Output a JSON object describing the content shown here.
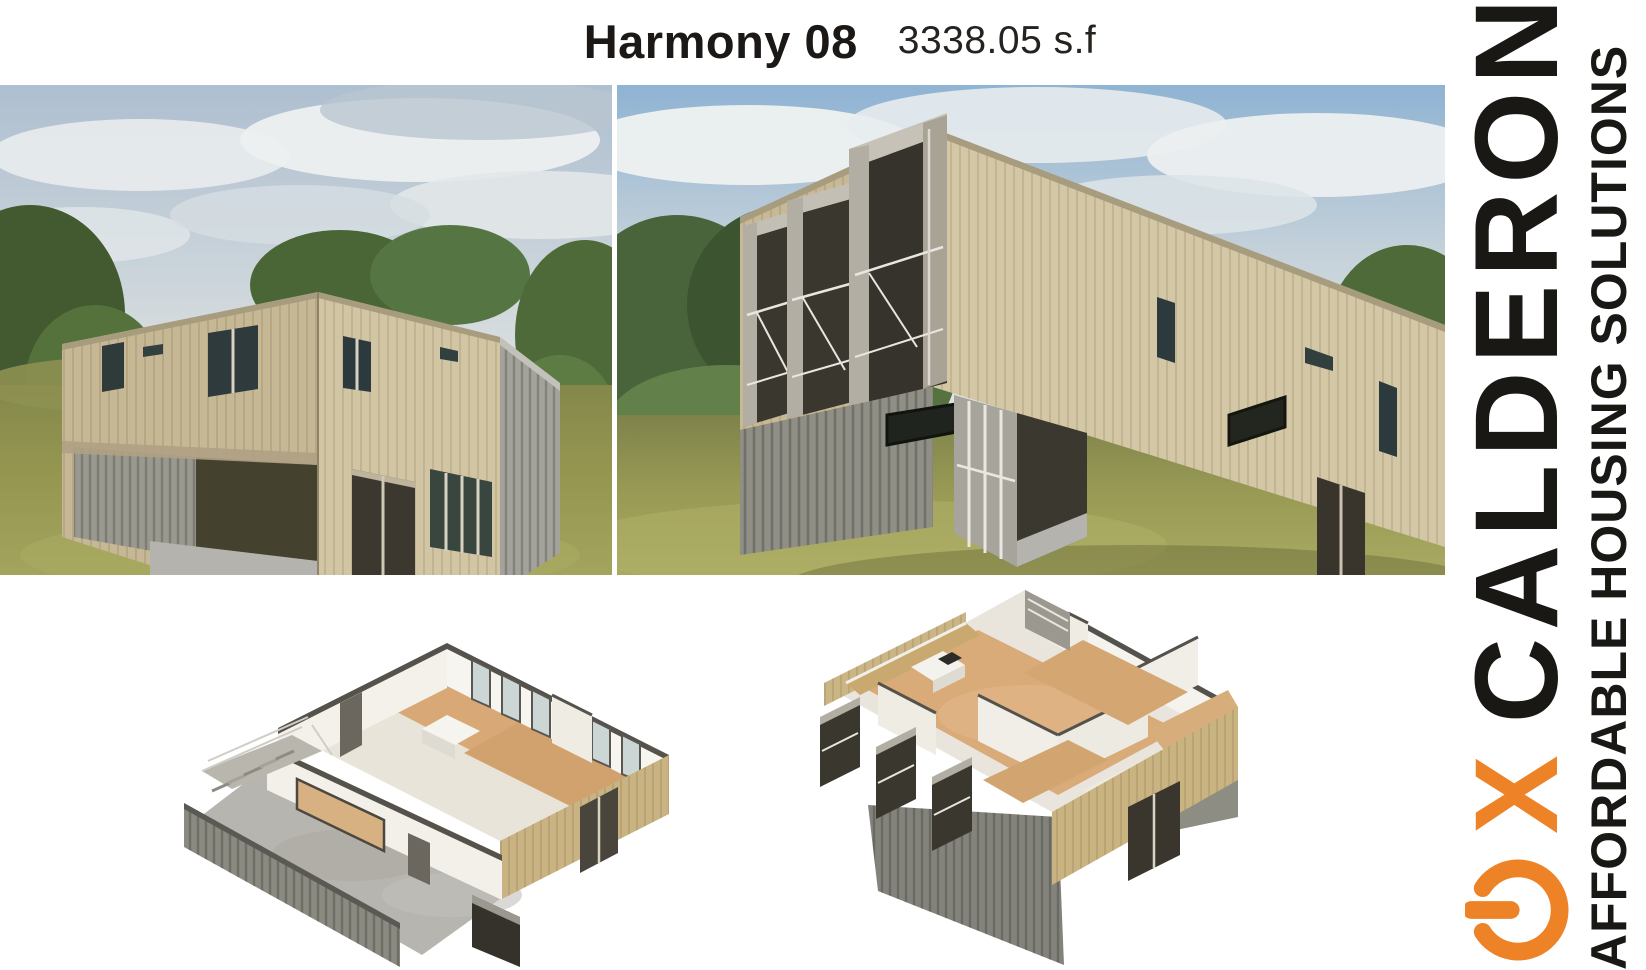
{
  "page": {
    "title": "Harmony 08",
    "area_label": "3338.05 s.f"
  },
  "brand": {
    "wordmark": "CALDERON",
    "wordmark_mark": "X",
    "tagline": "AFFORDABLE HOUSING SOLUTIONS",
    "orange": "#ED8227",
    "black": "#1A1815"
  }
}
